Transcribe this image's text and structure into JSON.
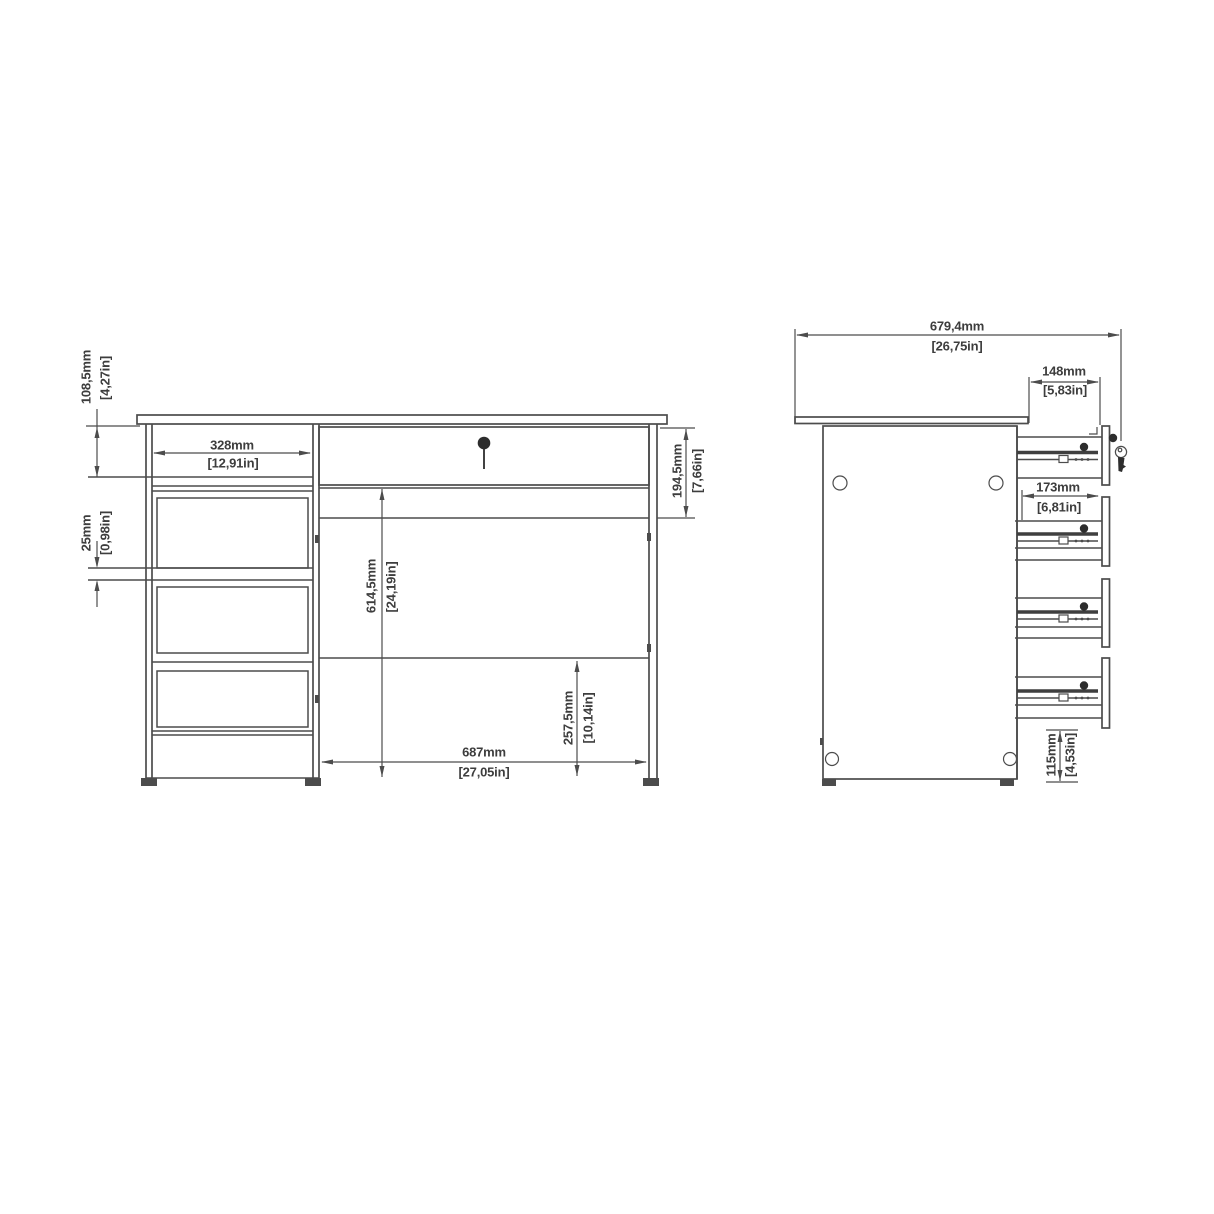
{
  "meta": {
    "background_color": "#ffffff",
    "line_color": "#4c4c4c",
    "text_color": "#3d3d3d",
    "icons": [
      "keyhole-icon",
      "key-icon"
    ]
  },
  "front_view": {
    "dims": {
      "top_height": {
        "mm": "108,5mm",
        "inch": "[4,27in]"
      },
      "drawer_width": {
        "mm": "328mm",
        "inch": "[12,91in]"
      },
      "drawer_gap": {
        "mm": "25mm",
        "inch": "[0,98in]"
      },
      "knee_height": {
        "mm": "614,5mm",
        "inch": "[24,19in]"
      },
      "apron_height": {
        "mm": "194,5mm",
        "inch": "[7,66in]"
      },
      "knee_width": {
        "mm": "687mm",
        "inch": "[27,05in]"
      },
      "modesty_clearance": {
        "mm": "257,5mm",
        "inch": "[10,14in]"
      }
    }
  },
  "side_view": {
    "dims": {
      "total_depth": {
        "mm": "679,4mm",
        "inch": "[26,75in]"
      },
      "top_drawer_depth": {
        "mm": "148mm",
        "inch": "[5,83in]"
      },
      "lower_drawer_depth": {
        "mm": "173mm",
        "inch": "[6,81in]"
      },
      "bottom_clearance": {
        "mm": "115mm",
        "inch": "[4,53in]"
      }
    }
  }
}
